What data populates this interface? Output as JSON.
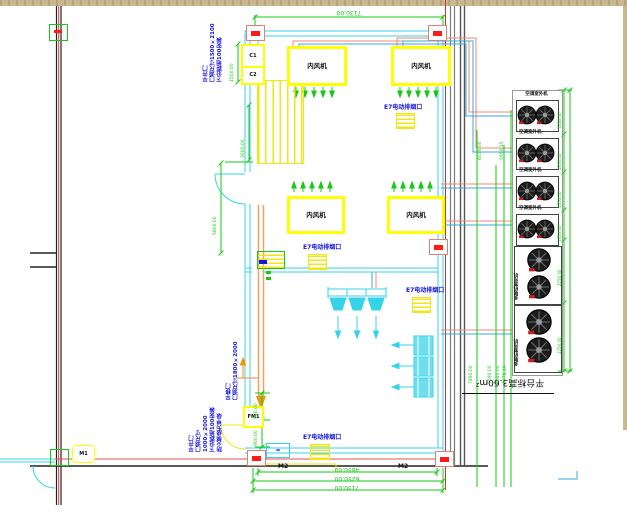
{
  "drawing": {
    "labels": {
      "indoor_unit": "内风机",
      "outdoor_unit_small": "空调室外机",
      "outdoor_unit_large": "多联机室外机",
      "platform_note": "平台标高3.60m²",
      "grille": "E7电动排烟口",
      "equipment_mark": "≈"
    },
    "tags": {
      "window_1": "C1",
      "window_2": "C2",
      "door_mid": "FM1",
      "door_left": "M1",
      "dim_tag_1": "M2",
      "dim_tag_2": "M2"
    },
    "notes": {
      "top_left": [
        "平开门",
        "门洞尺寸1500×2100",
        "下沿距地100安装"
      ],
      "mid_left": [
        "平移门",
        "门洞尺寸1800×2000"
      ],
      "bottom_left": [
        "平开门",
        "门洞尺寸1000×2000",
        "下沿距地100安装",
        "防火等级为甲级"
      ]
    },
    "dimensions": {
      "top": "7130.00",
      "bottom": [
        "4850.00",
        "6250.00",
        "7130.00"
      ],
      "left_upper": "1500.00",
      "left_mid": "3000.00",
      "left_lower": "5800.00",
      "door": [
        "900.00",
        "900.00"
      ],
      "risers_upper": [
        "6030.00",
        "5950.15"
      ],
      "risers_lower": [
        "7890.00",
        "7590.00",
        "7640.00",
        "7578.19"
      ],
      "unit_heights": [
        "1350.00",
        "1350.00",
        "1350.00",
        "1350.00",
        "2250.00",
        "2250.00"
      ]
    },
    "colors": {
      "wall_cyan": "#35d3e8",
      "dim_green": "#15c915",
      "pipe_orange": "#ef8971",
      "pipe_blue": "#38a8e0",
      "note_blue": "#1414dd",
      "hatch_yellow": "#f0e614",
      "marker_red": "#ff1a1a",
      "bar_tan": "#c9b78f"
    }
  }
}
